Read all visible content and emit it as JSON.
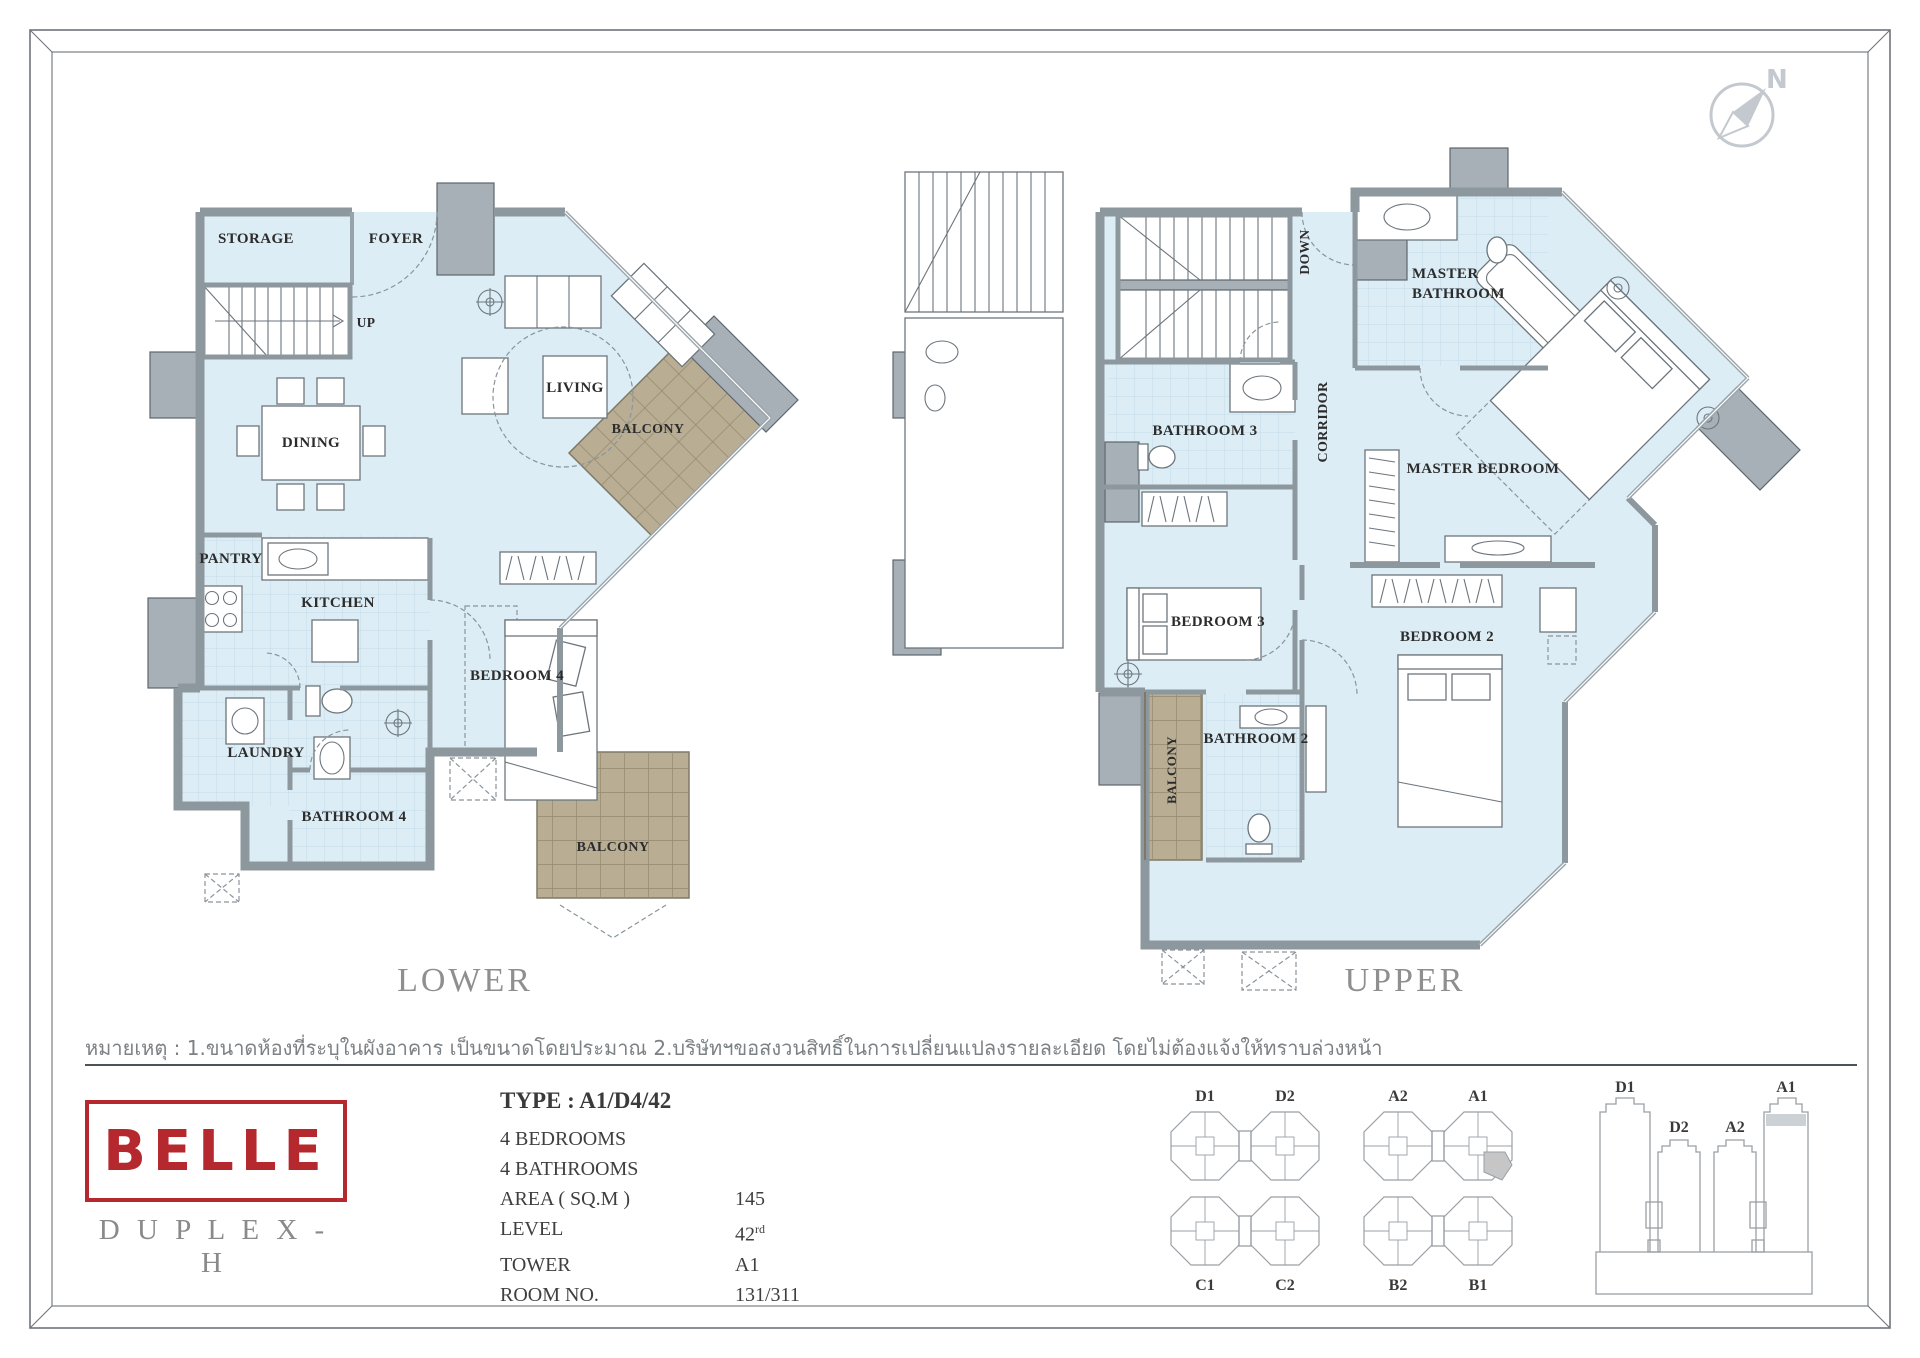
{
  "compass": {
    "label": "N"
  },
  "titles": {
    "lower": "LOWER",
    "upper": "UPPER"
  },
  "note": {
    "text": "หมายเหตุ : 1.ขนาดห้องที่ระบุในผังอาคาร เป็นขนาดโดยประมาณ 2.บริษัทฯขอสงวนสิทธิ์ในการเปลี่ยนแปลงรายละเอียด โดยไม่ต้องแจ้งให้ทราบล่วงหน้า"
  },
  "logo": {
    "brand": "BELLE",
    "series": "D U P L E X - H",
    "color": "#b5282e"
  },
  "specs": {
    "type": "TYPE : A1/D4/42",
    "bedrooms": "4 BEDROOMS",
    "bathrooms": "4 BATHROOMS",
    "area_label": "AREA ( SQ.M )",
    "area_value": "145",
    "level_label": "LEVEL",
    "level_value": "42",
    "level_sup": "rd",
    "tower_label": "TOWER",
    "tower_value": "A1",
    "room_label": "ROOM  NO.",
    "room_value": "131/311"
  },
  "floor_plans": {
    "lower": {
      "title": "LOWER",
      "rooms": [
        {
          "label": "STORAGE",
          "x": 256,
          "y": 243
        },
        {
          "label": "FOYER",
          "x": 396,
          "y": 243
        },
        {
          "label": "UP",
          "x": 366,
          "y": 327,
          "size": 13.5
        },
        {
          "label": "DINING",
          "x": 311,
          "y": 447
        },
        {
          "label": "LIVING",
          "x": 575,
          "y": 392
        },
        {
          "label": "PANTRY",
          "x": 231,
          "y": 563
        },
        {
          "label": "KITCHEN",
          "x": 338,
          "y": 607
        },
        {
          "label": "BEDROOM 4",
          "x": 517,
          "y": 680
        },
        {
          "label": "LAUNDRY",
          "x": 266,
          "y": 757
        },
        {
          "label": "BATHROOM 4",
          "x": 354,
          "y": 821
        },
        {
          "label": "BALCONY",
          "x": 648,
          "y": 433,
          "size": 14
        },
        {
          "label": "BALCONY",
          "x": 613,
          "y": 851,
          "size": 14
        }
      ]
    },
    "upper": {
      "title": "UPPER",
      "rooms": [
        {
          "label": "DOWN",
          "x": 1309,
          "y": 252,
          "rotate": -90,
          "size": 13.5
        },
        {
          "label": "MASTER BATHROOM",
          "lines": [
            "MASTER",
            "BATHROOM"
          ],
          "x": 1412,
          "y": 278,
          "anchor": "start"
        },
        {
          "label": "BATHROOM 3",
          "x": 1205,
          "y": 435
        },
        {
          "label": "CORRIDOR",
          "x": 1327,
          "y": 422,
          "rotate": -90,
          "size": 14
        },
        {
          "label": "MASTER BEDROOM",
          "x": 1483,
          "y": 473
        },
        {
          "label": "BEDROOM 3",
          "x": 1218,
          "y": 626
        },
        {
          "label": "BEDROOM 2",
          "x": 1447,
          "y": 641
        },
        {
          "label": "BATHROOM 2",
          "x": 1256,
          "y": 743
        },
        {
          "label": "BALCONY",
          "x": 1176,
          "y": 770,
          "rotate": -90,
          "size": 13
        }
      ]
    }
  },
  "site_plan": {
    "cluster_labels": [
      {
        "label": "D1",
        "x": 1205,
        "y": 1101
      },
      {
        "label": "D2",
        "x": 1285,
        "y": 1101
      },
      {
        "label": "A2",
        "x": 1398,
        "y": 1101
      },
      {
        "label": "A1",
        "x": 1478,
        "y": 1101
      },
      {
        "label": "C1",
        "x": 1205,
        "y": 1290
      },
      {
        "label": "C2",
        "x": 1285,
        "y": 1290
      },
      {
        "label": "B2",
        "x": 1398,
        "y": 1290
      },
      {
        "label": "B1",
        "x": 1478,
        "y": 1290
      }
    ],
    "highlighted_unit_tower": "A1"
  },
  "elevation": {
    "tower_labels": [
      {
        "label": "D1",
        "x": 1625,
        "y": 1092
      },
      {
        "label": "D2",
        "x": 1679,
        "y": 1132
      },
      {
        "label": "A2",
        "x": 1735,
        "y": 1132
      },
      {
        "label": "A1",
        "x": 1786,
        "y": 1092
      }
    ],
    "highlighted_tower": "A1"
  },
  "colors": {
    "floor": "#ddedf5",
    "wall": "#8d979e",
    "balcony": "#b9ae94",
    "brand_red": "#b5282e",
    "diagram_gray": "#9aa0a5"
  }
}
